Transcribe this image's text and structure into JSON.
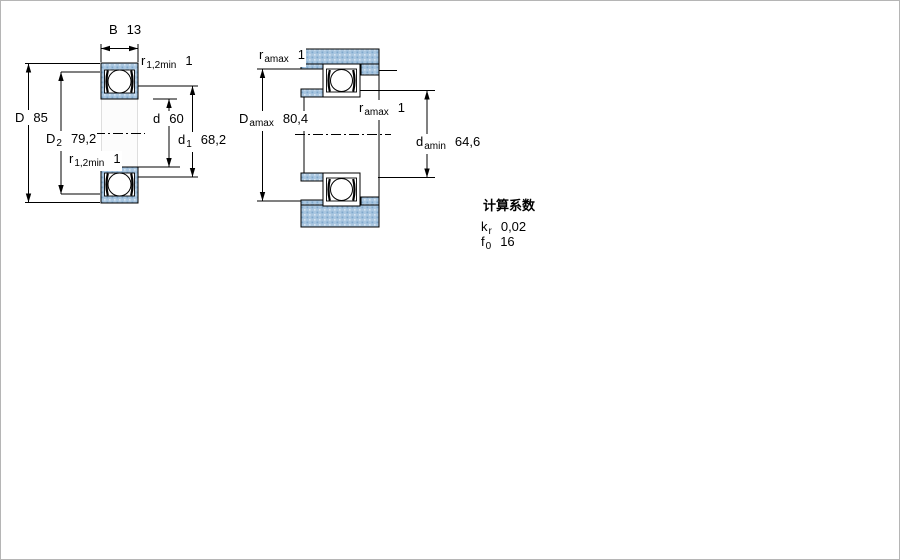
{
  "page": {
    "background": "#ffffff"
  },
  "colors": {
    "section_fill_base": "#a9c6e0",
    "section_dot_dark": "#7fa8cc",
    "section_dot_light": "#d6e4f1",
    "line": "#000000"
  },
  "bearing_drawing": {
    "labels": {
      "width": {
        "symbol": "B",
        "value": "13"
      },
      "outside_diameter": {
        "symbol": "D",
        "value": "85"
      },
      "recess_diameter": {
        "symbol": "D",
        "sub": "2",
        "value": "79,2"
      },
      "bore_diameter": {
        "symbol": "d",
        "value": "60"
      },
      "shoulder_diameter": {
        "symbol": "d",
        "sub": "1",
        "value": "68,2"
      },
      "chamfer_top": {
        "symbol": "r",
        "sub": "1,2min",
        "value": "1"
      },
      "chamfer_bottom": {
        "symbol": "r",
        "sub": "1,2min",
        "value": "1"
      }
    }
  },
  "mounting_drawing": {
    "labels": {
      "housing_fillet": {
        "symbol": "r",
        "sub": "amax",
        "value": "1"
      },
      "abutment_diameter_max": {
        "symbol": "D",
        "sub": "amax",
        "value": "80,4"
      },
      "shaft_fillet": {
        "symbol": "r",
        "sub": "amax",
        "value": "1"
      },
      "abutment_diameter_min": {
        "symbol": "d",
        "sub": "amin",
        "value": "64,6"
      }
    }
  },
  "calculation_factors": {
    "title": "计算系数",
    "rows": [
      {
        "symbol": "k",
        "sub": "r",
        "value": "0,02"
      },
      {
        "symbol": "f",
        "sub": "0",
        "value": "16"
      }
    ]
  }
}
